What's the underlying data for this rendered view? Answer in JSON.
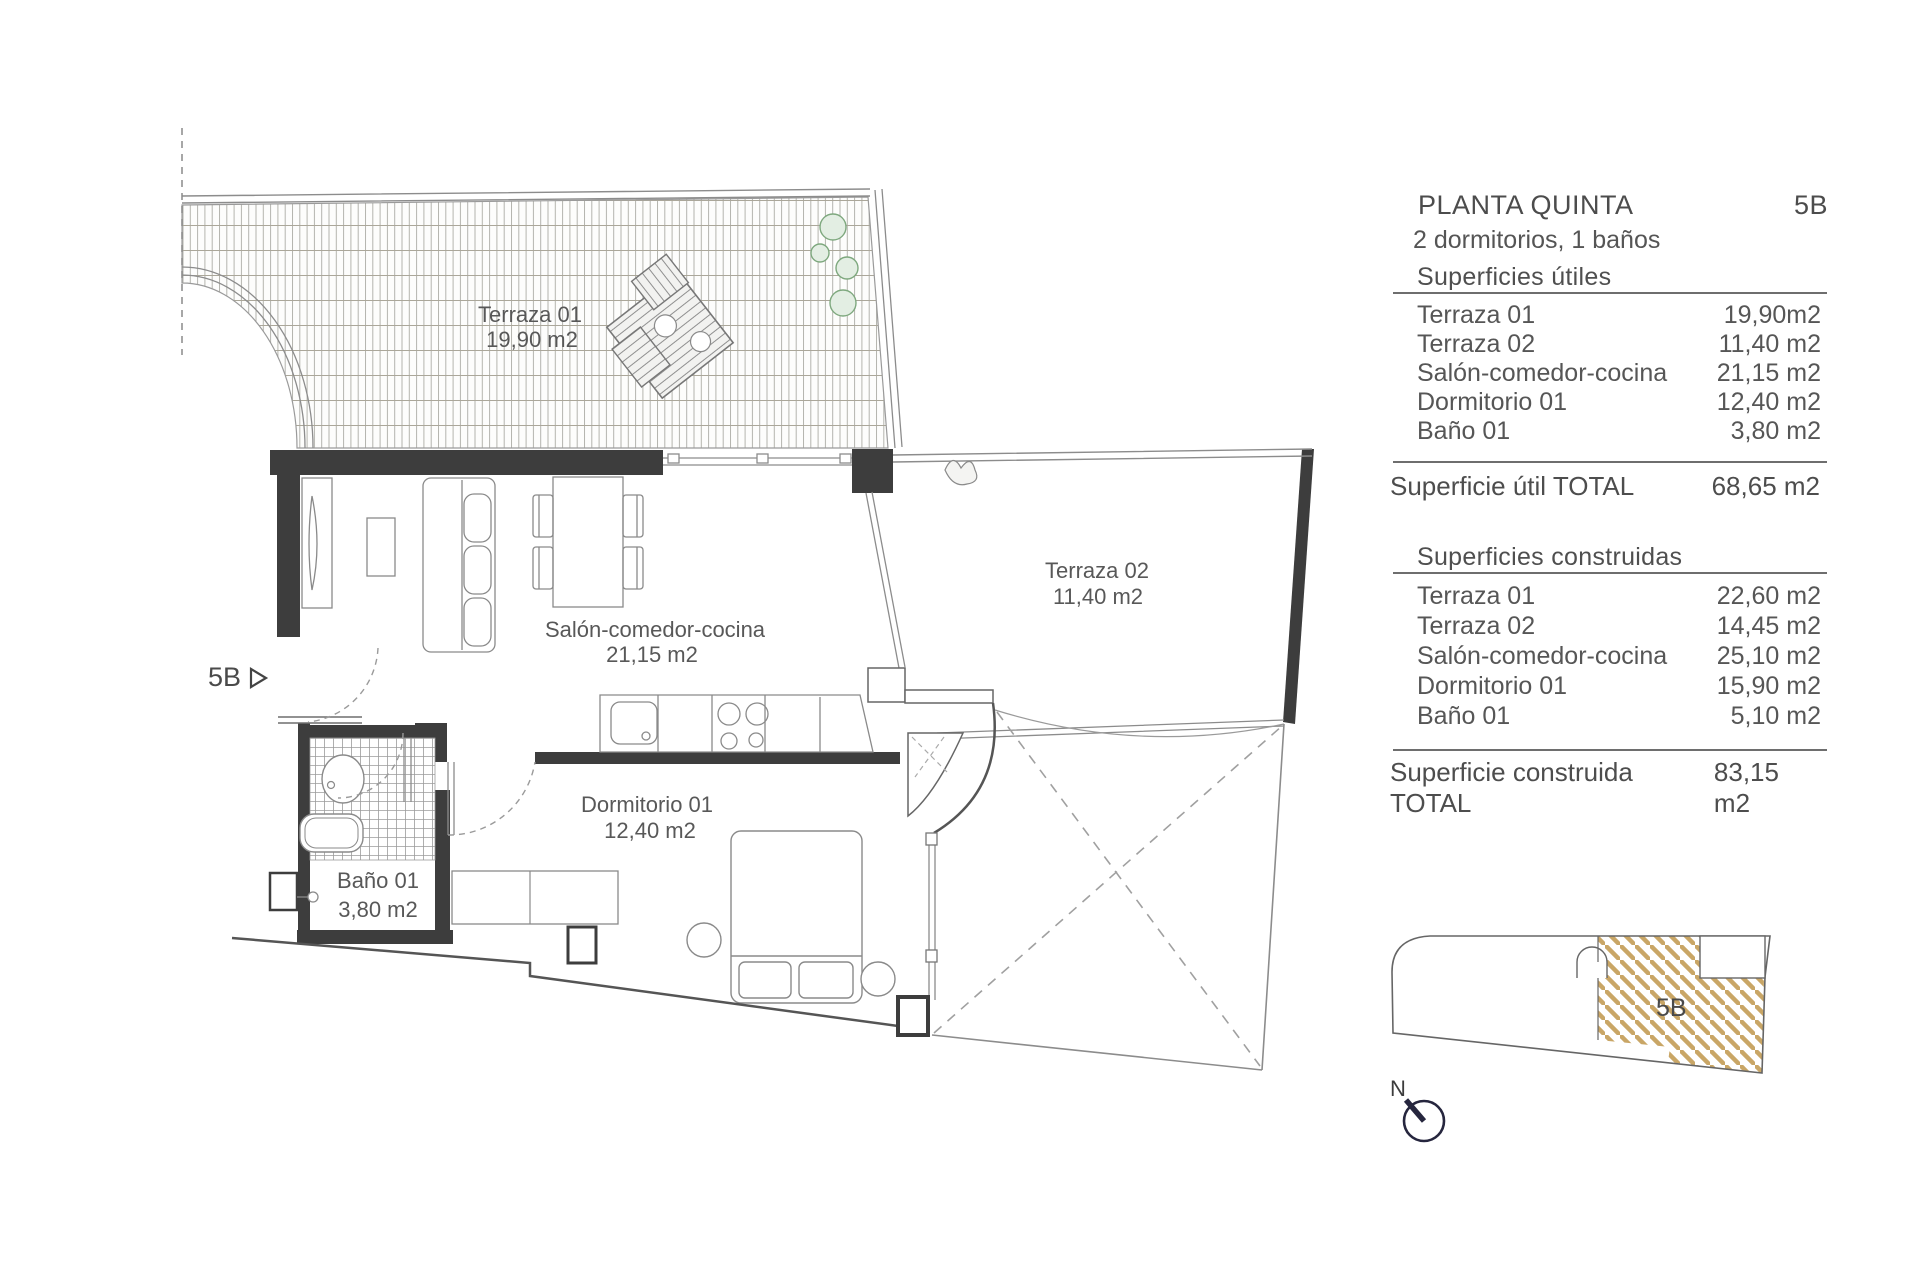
{
  "plan": {
    "entrance_marker": "5B",
    "rooms": [
      {
        "name": "Terraza 01",
        "area": "19,90 m2"
      },
      {
        "name": "Terraza 02",
        "area": "11,40 m2"
      },
      {
        "name": "Salón-comedor-cocina",
        "area": "21,15 m2"
      },
      {
        "name": "Dormitorio 01",
        "area": "12,40 m2"
      },
      {
        "name": "Baño 01",
        "area": "3,80 m2"
      }
    ]
  },
  "panel": {
    "title": "PLANTA QUINTA",
    "unit": "5B",
    "subtitle": "2 dormitorios, 1 baños",
    "useful": {
      "heading": "Superficies útiles",
      "rows": [
        {
          "label": "Terraza 01",
          "value": "19,90m2"
        },
        {
          "label": "Terraza 02",
          "value": "11,40 m2"
        },
        {
          "label": "Salón-comedor-cocina",
          "value": "21,15 m2"
        },
        {
          "label": "Dormitorio 01",
          "value": "12,40 m2"
        },
        {
          "label": "Baño 01",
          "value": "3,80 m2"
        }
      ],
      "total_label": "Superficie útil TOTAL",
      "total_value": "68,65 m2"
    },
    "built": {
      "heading": "Superficies construidas",
      "rows": [
        {
          "label": "Terraza 01",
          "value": "22,60 m2"
        },
        {
          "label": "Terraza 02",
          "value": "14,45 m2"
        },
        {
          "label": "Salón-comedor-cocina",
          "value": "25,10 m2"
        },
        {
          "label": "Dormitorio 01",
          "value": "15,90 m2"
        },
        {
          "label": "Baño 01",
          "value": "5,10 m2"
        }
      ],
      "total_label": "Superficie construida TOTAL",
      "total_value": "83,15 m2"
    }
  },
  "keyplan": {
    "unit_label": "5B",
    "north_label": "N"
  },
  "colors": {
    "wall": "#3d3d3d",
    "thin_line": "#8c8c8c",
    "hatch_gold": "#c9a666",
    "plant_green": "#7ea87e",
    "north_navy": "#26263e",
    "text": "#4f4f4f"
  }
}
